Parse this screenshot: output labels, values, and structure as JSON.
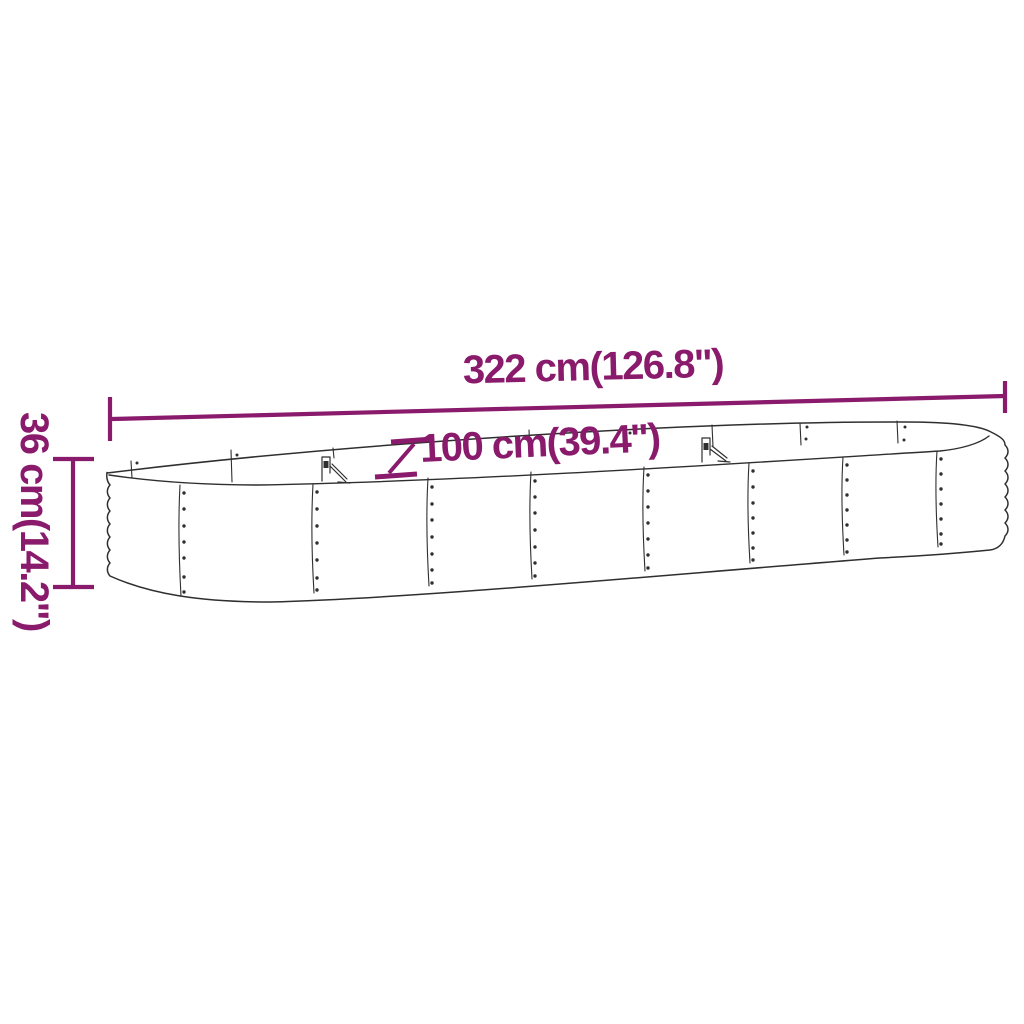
{
  "diagram": {
    "drawing": "oval-raised-garden-bed-line-drawing",
    "background": "#ffffff",
    "accent_color": "#8a1a6b",
    "line_color": "#2f2f2f",
    "dimensions": {
      "length": {
        "cm": 322,
        "inches": 126.8,
        "label": "322 cm(126.8\")"
      },
      "width": {
        "cm": 100,
        "inches": 39.4,
        "label": "100 cm(39.4\")"
      },
      "height": {
        "cm": 36,
        "inches": 14.2,
        "label": "36 cm(14.2\")"
      }
    }
  }
}
